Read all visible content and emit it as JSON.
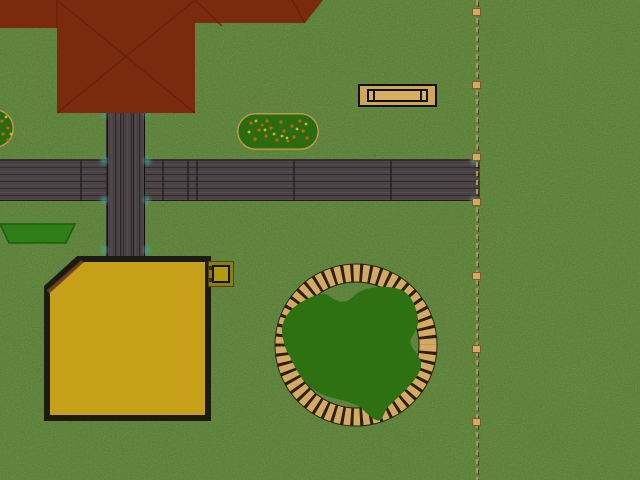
{
  "app": {
    "name": "garden-scene",
    "description": "Top-down garden planner view: house roof, wooden paths, sandbox, benches, flower beds, round log-edged planting bed and dashed boundary fence on a grass lawn"
  },
  "canvas": {
    "width": 640,
    "height": 480
  },
  "colors": {
    "grass": "#4c742a",
    "path": "#4a4145",
    "path-seam": "#282326",
    "roof": "#7a2a0e",
    "roof-ridge": "#671f09",
    "wood-tan": "#cfa65a",
    "wood-tan-light": "#d8ae63",
    "outline-black": "#0f0f0a",
    "bed-green": "#2c6c10",
    "bed-border": "#c39a50",
    "flower-orange": "#cc5f17",
    "flower-yellow": "#cbbd20",
    "hedge-green": "#2e7d17",
    "hedge-edge": "#1e5c0e",
    "sandbox-sand": "#c6a018",
    "sandbox-border": "#1b1b11",
    "box-outer": "#8e7c10",
    "box-inner": "#b2990f",
    "island-green": "#2d7113",
    "ring-slat": "#d3a964",
    "ring-gap": "#2b2014",
    "fence-line": "#b5955c",
    "fence-post": "#d4aa60",
    "fence-post-border": "#7a5c2c",
    "marker-teal": "#46a096"
  },
  "objects": {
    "house_roof": {
      "label": "hipped house roof (top-down)"
    },
    "path_horizontal": {
      "label": "wooden plank path, east-west"
    },
    "path_vertical": {
      "label": "wooden plank path, north-south"
    },
    "bench": {
      "label": "garden bench"
    },
    "flowerbed_right": {
      "label": "oval flower bed with flowers"
    },
    "flowerbed_left": {
      "label": "oval flower bed (clipped at screen edge)"
    },
    "hedge": {
      "label": "trimmed hedge block"
    },
    "sandbox": {
      "label": "sandbox with corner seat board"
    },
    "storage_box": {
      "label": "small storage box"
    },
    "island_bed": {
      "label": "round planting bed with radial log edging"
    },
    "fence": {
      "label": "dashed boundary fence with posts"
    },
    "path_markers": {
      "label": "teal path connection markers"
    }
  }
}
